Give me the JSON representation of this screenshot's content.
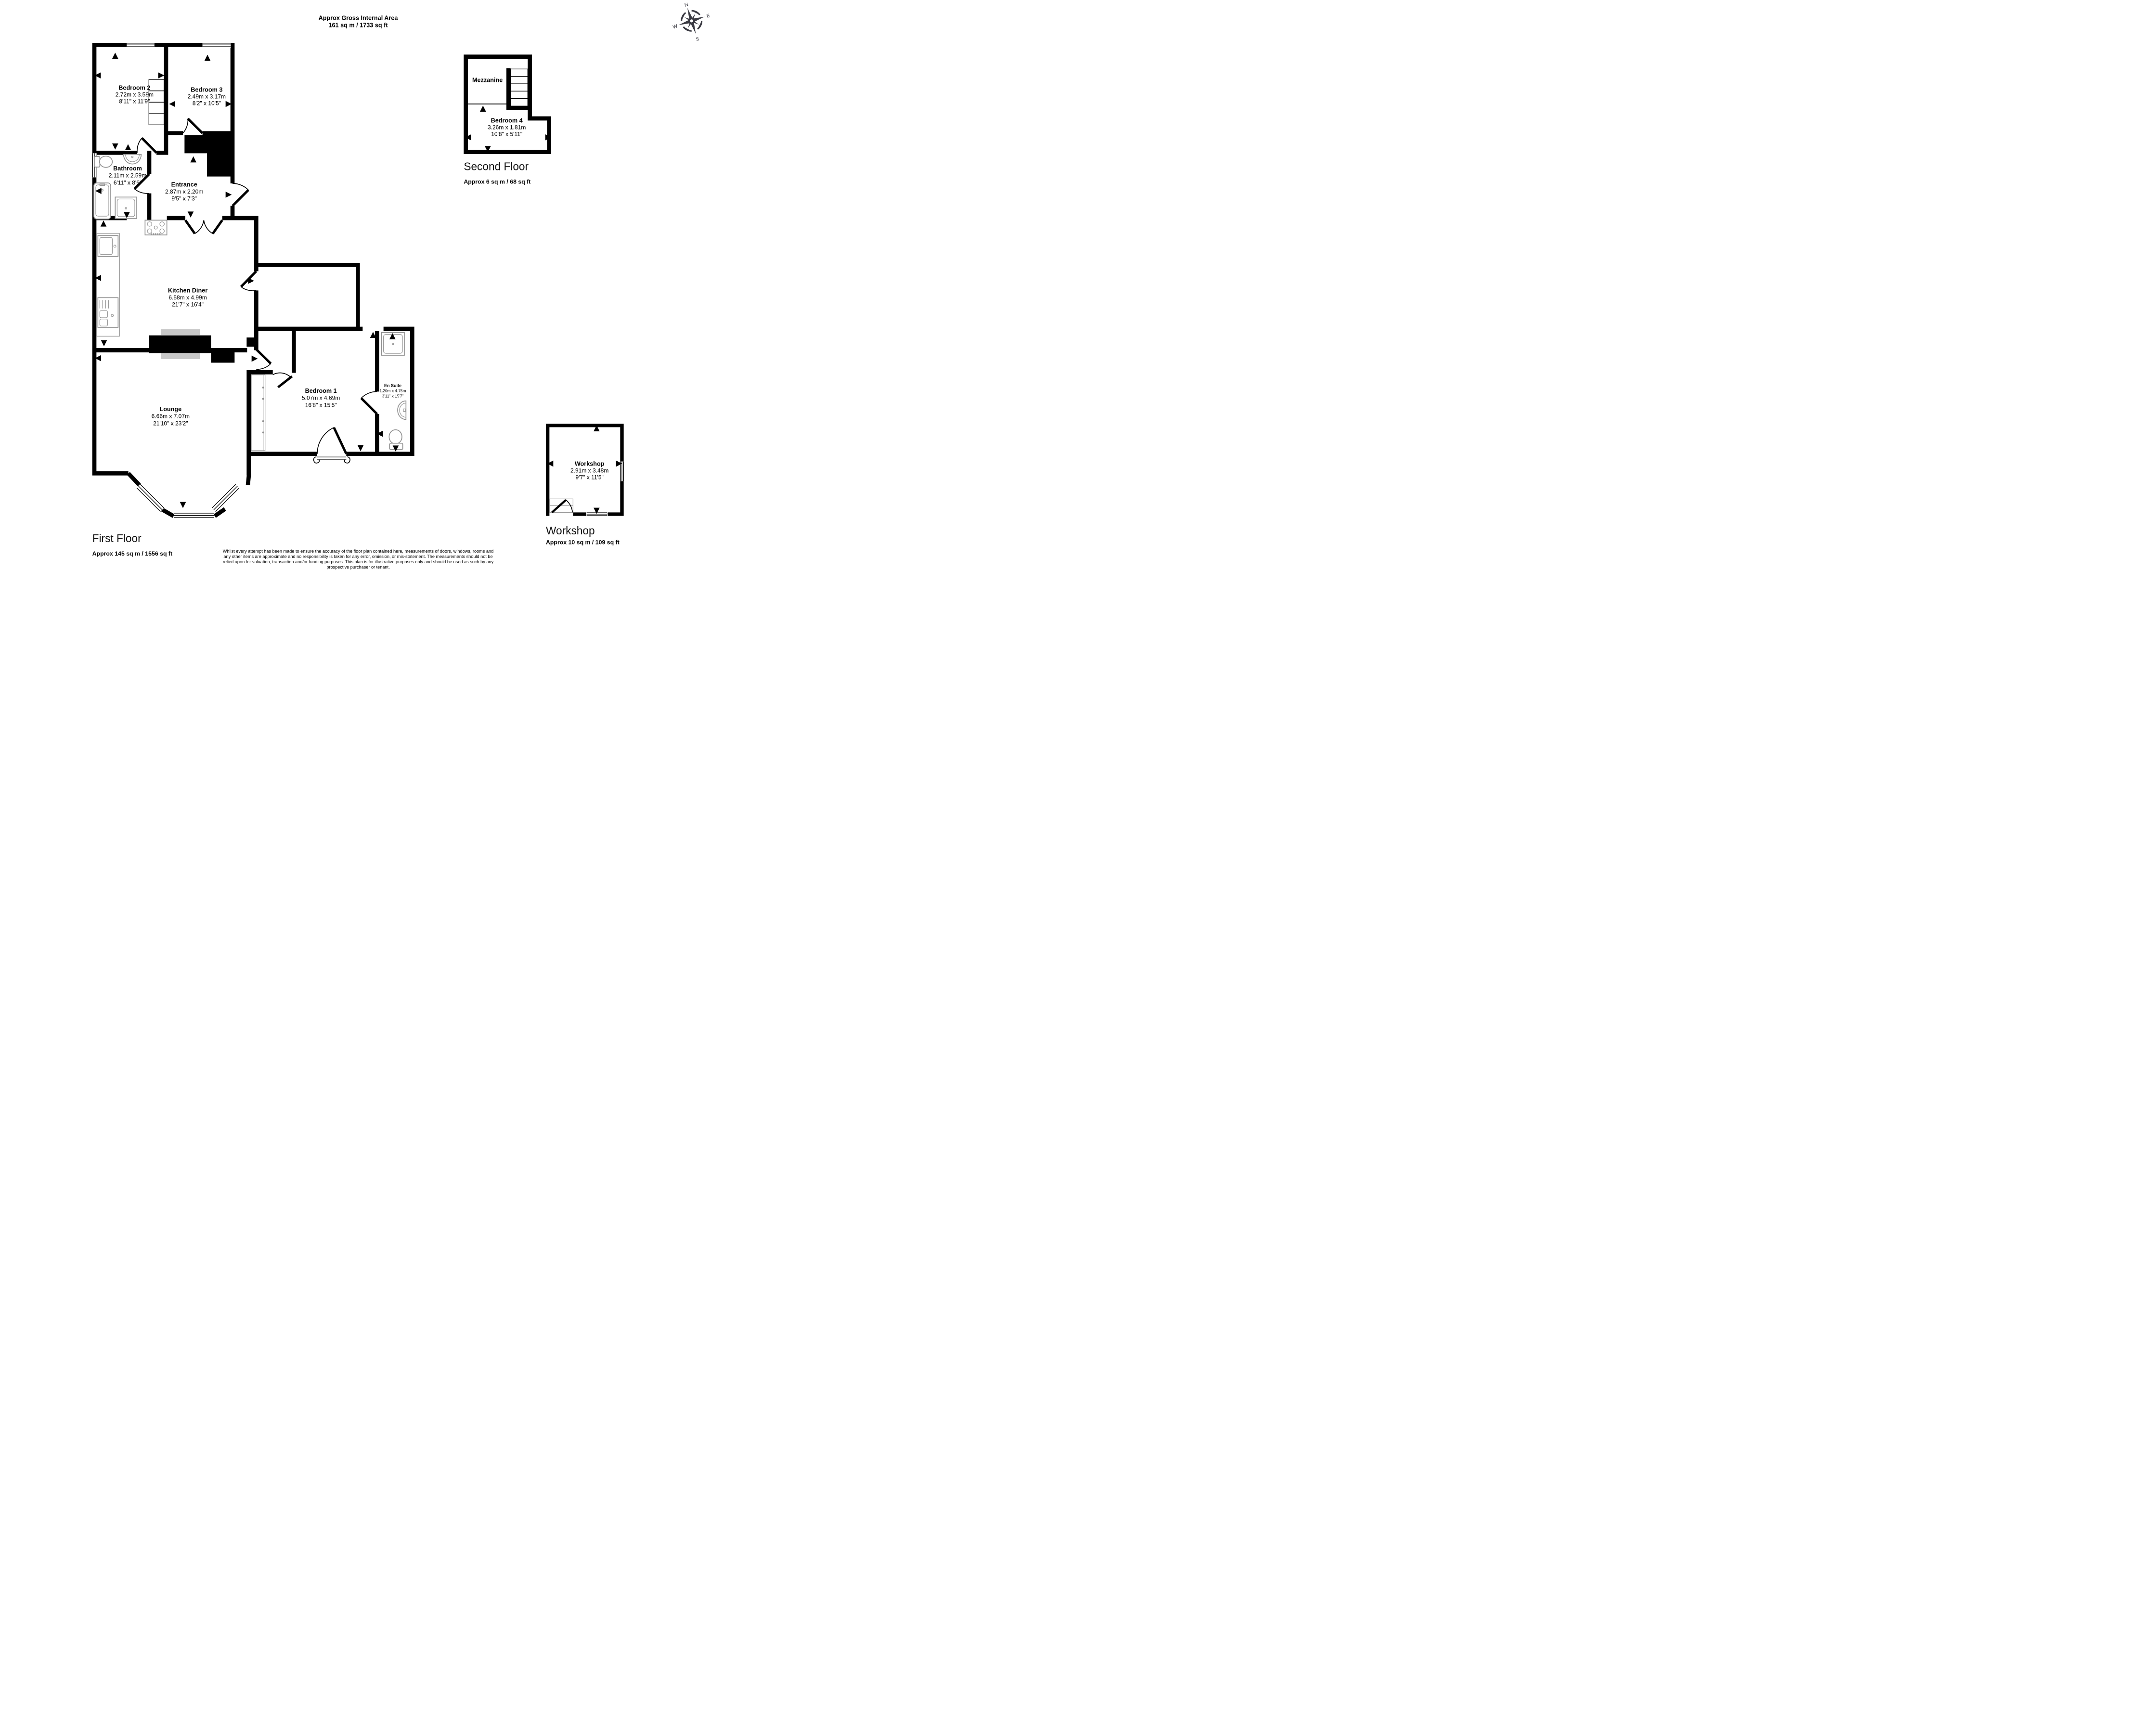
{
  "header": {
    "title": "Approx Gross Internal Area",
    "area": "161 sq m / 1733 sq ft"
  },
  "compass": {
    "n": "N",
    "e": "E",
    "s": "S",
    "w": "W"
  },
  "first_floor": {
    "label": "First Floor",
    "area": "Approx 145 sq m / 1556 sq ft",
    "rooms": {
      "bedroom2": {
        "name": "Bedroom 2",
        "metric": "2.72m x 3.59m",
        "imperial": "8'11\" x 11'9\""
      },
      "bedroom3": {
        "name": "Bedroom 3",
        "metric": "2.49m x 3.17m",
        "imperial": "8'2\" x 10'5\""
      },
      "bathroom": {
        "name": "Bathroom",
        "metric": "2.11m x 2.59m",
        "imperial": "6'11\" x 8'6\""
      },
      "entrance": {
        "name": "Entrance",
        "metric": "2.87m x 2.20m",
        "imperial": "9'5\" x 7'3\""
      },
      "kitchen": {
        "name": "Kitchen Diner",
        "metric": "6.58m x 4.99m",
        "imperial": "21'7\" x 16'4\""
      },
      "lounge": {
        "name": "Lounge",
        "metric": "6.66m x 7.07m",
        "imperial": "21'10\" x 23'2\""
      },
      "bedroom1": {
        "name": "Bedroom 1",
        "metric": "5.07m x 4.69m",
        "imperial": "16'8\" x 15'5\""
      },
      "ensuite": {
        "name": "En Suite",
        "metric": "1.20m x 4.75m",
        "imperial": "3'11\" x 15'7\""
      }
    }
  },
  "second_floor": {
    "label": "Second Floor",
    "area": "Approx 6 sq m / 68 sq ft",
    "rooms": {
      "mezzanine": {
        "name": "Mezzanine"
      },
      "bedroom4": {
        "name": "Bedroom 4",
        "metric": "3.26m x 1.81m",
        "imperial": "10'8\" x 5'11\""
      }
    }
  },
  "workshop_floor": {
    "label": "Workshop",
    "area": "Approx 10 sq m / 109 sq ft",
    "rooms": {
      "workshop": {
        "name": "Workshop",
        "metric": "2.91m x 3.48m",
        "imperial": "9'7\" x 11'5\""
      }
    }
  },
  "disclaimer": {
    "lines": [
      "Whilst every attempt has been made to ensure the accuracy of the floor plan contained here, measurements of doors, windows, rooms and",
      "any other items are approximate and no responsibility is taken for any error, omission, or mis-statement. The measurements should not be",
      "relied upon for valuation, transaction and/or funding purposes. This plan is for illustrative purposes only and should be used as such by any",
      "prospective purchaser or tenant."
    ]
  },
  "colors": {
    "wall": "#000000",
    "fixture": "#8f8f8f",
    "hearth": "#c8c8c8",
    "compass": "#3a3a42"
  }
}
